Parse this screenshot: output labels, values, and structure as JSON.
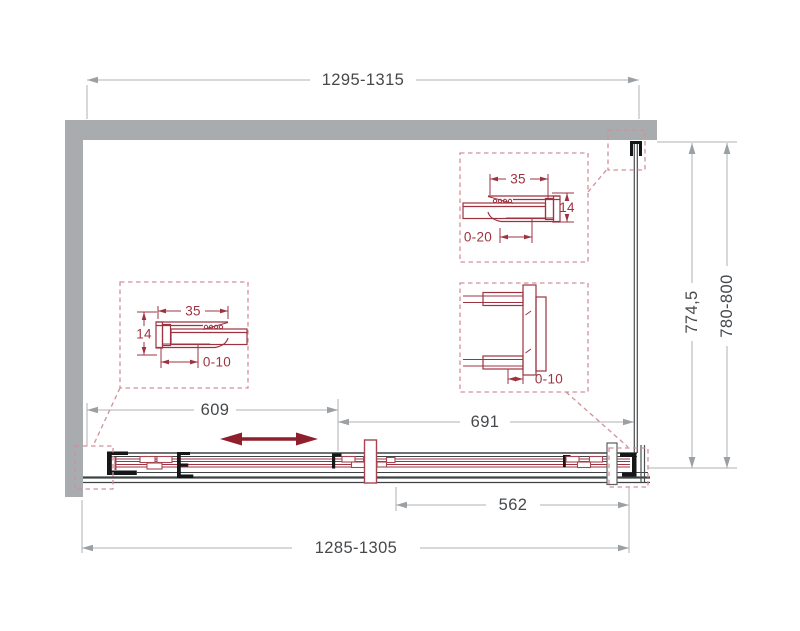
{
  "dimensions": {
    "top_width": "1295-1315",
    "bottom_width": "1285-1305",
    "fixed_panel_width": "609",
    "door_panel_width": "691",
    "slide_width": "562",
    "depth_glass": "774,5",
    "depth_total": "780-800"
  },
  "details": {
    "left_profile": {
      "width": "35",
      "thickness": "14",
      "adjustment": "0-10"
    },
    "top_right_profile": {
      "width": "35",
      "thickness": "14",
      "adjustment": "0-20"
    },
    "bottom_right_profile": {
      "adjustment": "0-10"
    }
  },
  "colors": {
    "wall_gray": "#a8acae",
    "outline_dark": "#3f4345",
    "dimension_gray": "#aeb2b4",
    "dimension_text": "#46494c",
    "detail_red": "#9e3340",
    "dashed_red": "#d2909a",
    "slide_arrow_red": "#8e1f2d"
  }
}
